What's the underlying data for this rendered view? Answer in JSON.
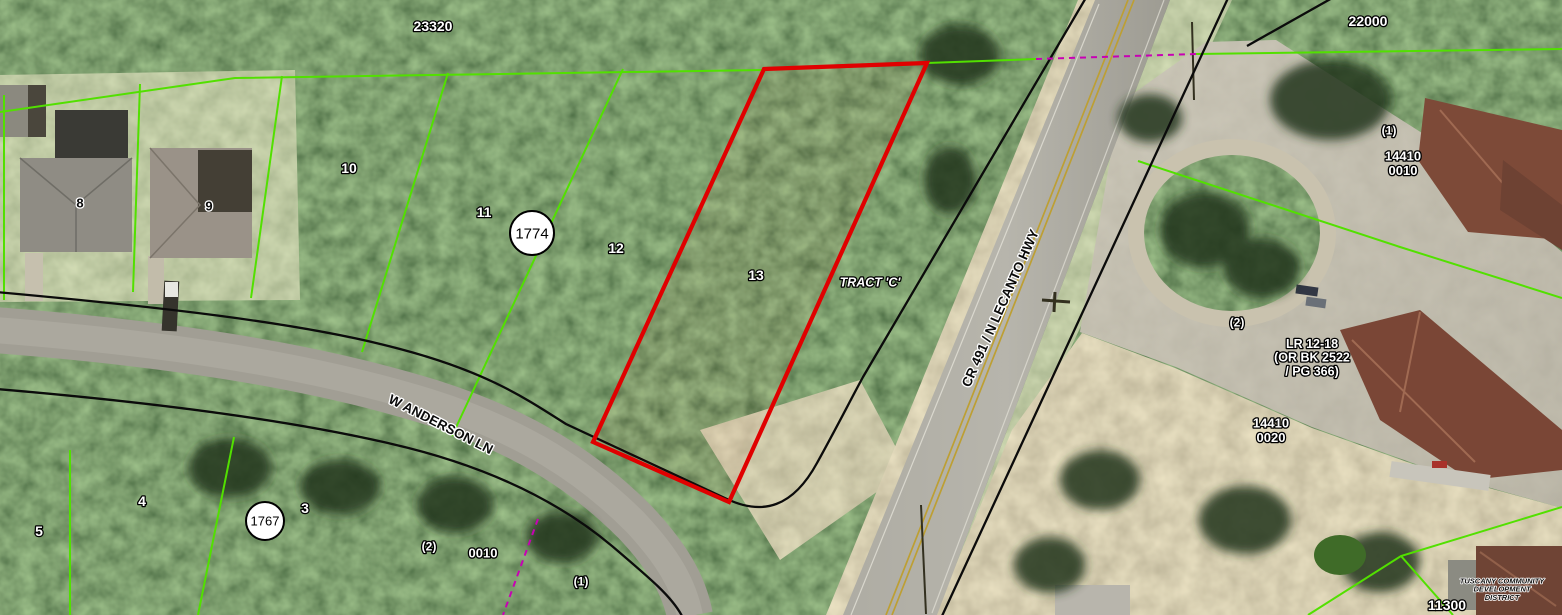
{
  "map": {
    "description": "county-property-appraiser-aerial-parcel-map",
    "colors": {
      "parcel_line": "#52e000",
      "selected_parcel_outline": "#e00000",
      "right_of_way_line": "#0b0b0b",
      "boundary_dashed": "#c800b4",
      "label_white": "#ffffff",
      "label_dark": "#0a0a0a",
      "highway_centerline": "#bd9f33"
    },
    "roads": [
      {
        "name": "CR 491 / N LECANTO HWY"
      },
      {
        "name": "W ANDERSON LN"
      }
    ],
    "plat_markers": [
      {
        "number": "1774"
      },
      {
        "number": "1767"
      }
    ],
    "selected_parcel": {
      "adjacent_lot": "13",
      "tract_label": "TRACT 'C'"
    },
    "labels": [
      {
        "id": "plat-23320",
        "text": "23320",
        "x": 433,
        "y": 26,
        "kind": "white",
        "fs": 14
      },
      {
        "id": "plat-22000",
        "text": "22000",
        "x": 1368,
        "y": 21,
        "kind": "white",
        "fs": 14
      },
      {
        "id": "lot-10",
        "text": "10",
        "x": 349,
        "y": 168,
        "kind": "white",
        "fs": 14
      },
      {
        "id": "lot-11",
        "text": "11",
        "x": 484,
        "y": 212,
        "kind": "white",
        "fs": 14
      },
      {
        "id": "lot-12",
        "text": "12",
        "x": 616,
        "y": 248,
        "kind": "white",
        "fs": 14
      },
      {
        "id": "lot-13",
        "text": "13",
        "x": 756,
        "y": 275,
        "kind": "white",
        "fs": 14
      },
      {
        "id": "lot-8",
        "text": "8",
        "x": 80,
        "y": 203,
        "kind": "dark",
        "fs": 13
      },
      {
        "id": "lot-9",
        "text": "9",
        "x": 209,
        "y": 206,
        "kind": "dark",
        "fs": 13
      },
      {
        "id": "lot-5",
        "text": "5",
        "x": 39,
        "y": 531,
        "kind": "white",
        "fs": 14
      },
      {
        "id": "lot-4",
        "text": "4",
        "x": 142,
        "y": 501,
        "kind": "white",
        "fs": 14
      },
      {
        "id": "lot-3",
        "text": "3",
        "x": 305,
        "y": 508,
        "kind": "white",
        "fs": 14
      },
      {
        "id": "marker-1774",
        "text": "1774",
        "x": 532,
        "y": 233,
        "kind": "circle",
        "fs": 15,
        "r": 22
      },
      {
        "id": "marker-1767",
        "text": "1767",
        "x": 265,
        "y": 521,
        "kind": "circle",
        "fs": 13,
        "r": 19
      },
      {
        "id": "tract-c",
        "text": "TRACT 'C'",
        "x": 870,
        "y": 282,
        "kind": "tract",
        "fs": 12.5
      },
      {
        "id": "road-cr491",
        "text": "CR 491 / N LECANTO HWY",
        "x": 1000,
        "y": 308,
        "kind": "dark",
        "fs": 13.5,
        "rot": -66
      },
      {
        "id": "road-anderson",
        "text": "W ANDERSON LN",
        "x": 441,
        "y": 424,
        "kind": "dark",
        "fs": 13.5,
        "rot": 27
      },
      {
        "id": "ref-1-ne",
        "text": "(1)",
        "x": 1389,
        "y": 130,
        "kind": "white",
        "fs": 12
      },
      {
        "id": "parcel-14410-0010",
        "lines": [
          "14410",
          "0010"
        ],
        "x": 1403,
        "y": 163,
        "kind": "white",
        "fs": 13
      },
      {
        "id": "ref-2-e",
        "text": "(2)",
        "x": 1237,
        "y": 322,
        "kind": "white",
        "fs": 12
      },
      {
        "id": "ref-lr-12-18",
        "lines": [
          "LR 12-18",
          "(OR BK 2522",
          "/ PG 366)"
        ],
        "x": 1312,
        "y": 357,
        "kind": "white",
        "fs": 12.5
      },
      {
        "id": "parcel-14410-0020",
        "lines": [
          "14410",
          "0020"
        ],
        "x": 1271,
        "y": 430,
        "kind": "white",
        "fs": 13
      },
      {
        "id": "ref-2-s",
        "text": "(2)",
        "x": 429,
        "y": 546,
        "kind": "white",
        "fs": 12
      },
      {
        "id": "parcel-0010",
        "text": "0010",
        "x": 483,
        "y": 553,
        "kind": "white",
        "fs": 13
      },
      {
        "id": "ref-1-s",
        "text": "(1)",
        "x": 581,
        "y": 581,
        "kind": "white",
        "fs": 12
      },
      {
        "id": "plat-11300",
        "text": "11300",
        "x": 1447,
        "y": 605,
        "kind": "white",
        "fs": 14
      },
      {
        "id": "district-tuscany",
        "lines": [
          "TUSCANY COMMUNITY",
          "DEVELOPMENT",
          "DISTRICT"
        ],
        "x": 1502,
        "y": 589,
        "kind": "tuscany",
        "fs": 7.5
      }
    ]
  }
}
